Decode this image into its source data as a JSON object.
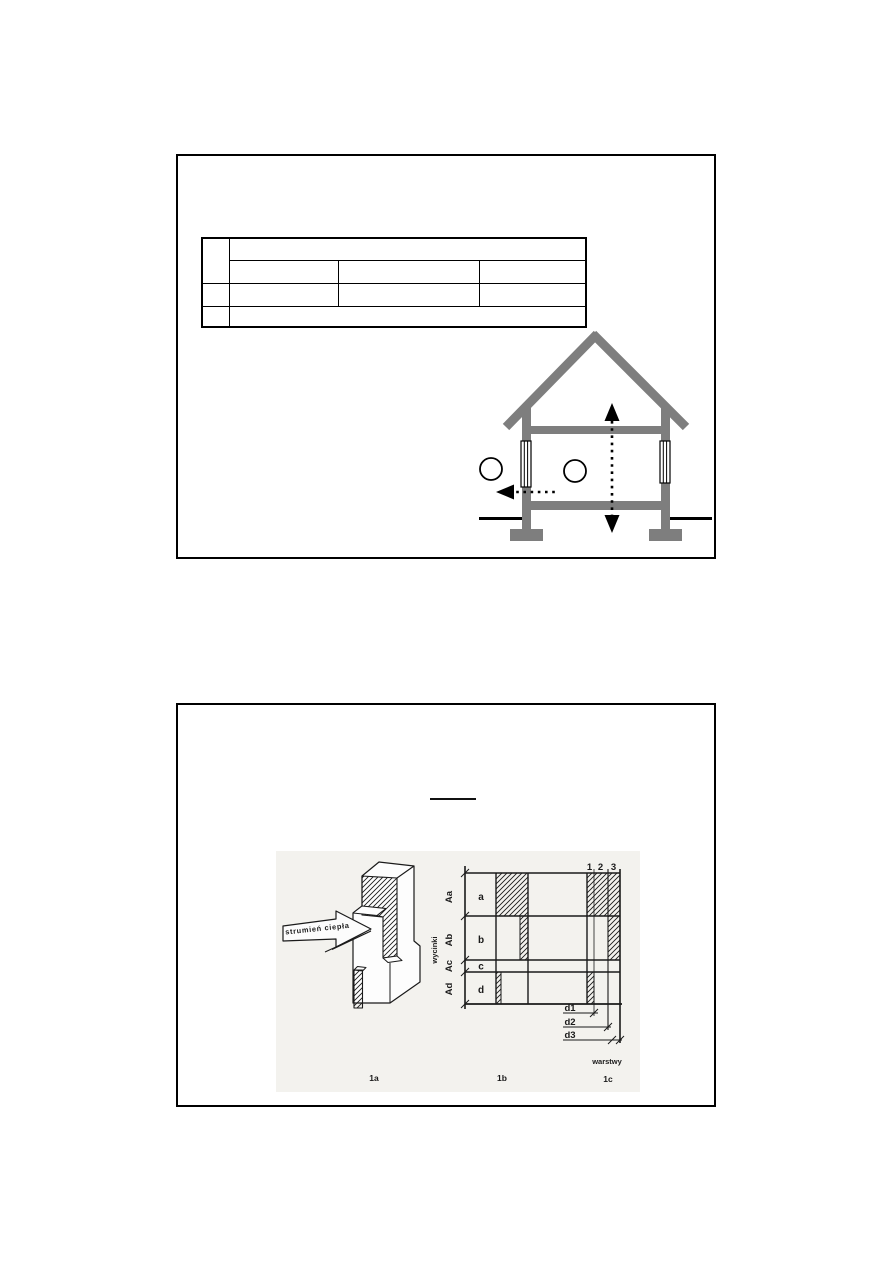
{
  "colors": {
    "panel_border": "#000000",
    "house_gray": "#7e7e7e",
    "scan_background": "#f3f2ee",
    "ink": "#1a1a1a"
  },
  "figure": {
    "arrow_label": "strumień ciepła",
    "row_labels": [
      "Aa",
      "Ab",
      "Ac",
      "Ad"
    ],
    "cut_labels": [
      "a",
      "b",
      "c",
      "d"
    ],
    "layer_numbers": [
      "1",
      "2",
      "3"
    ],
    "dims": [
      "d1",
      "d2",
      "d3"
    ],
    "left_axis": "wycinki",
    "bottom_axis": "warstwy",
    "captions": [
      "1a",
      "1b",
      "1c"
    ]
  }
}
